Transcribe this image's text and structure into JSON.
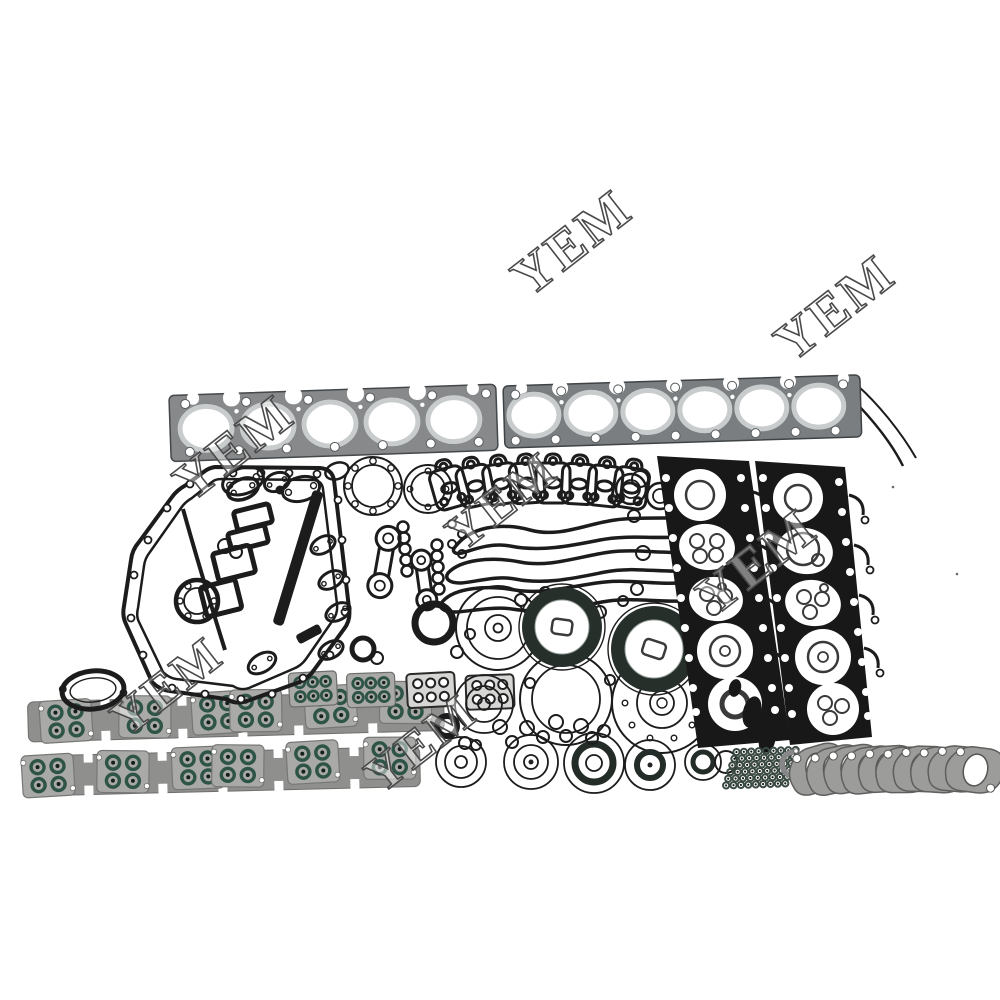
{
  "image": {
    "kind": "product-photo",
    "subject": "engine-overhaul-full-gasket-kit",
    "background": "#ffffff"
  },
  "watermarks": {
    "text": "YEM",
    "instances": [
      {
        "x": 575,
        "y": 247,
        "rotation": -38,
        "size": 54
      },
      {
        "x": 838,
        "y": 312,
        "rotation": -38,
        "size": 54
      },
      {
        "x": 237,
        "y": 452,
        "rotation": -38,
        "size": 54
      },
      {
        "x": 505,
        "y": 505,
        "rotation": -38,
        "size": 50
      },
      {
        "x": 760,
        "y": 566,
        "rotation": -38,
        "size": 54
      },
      {
        "x": 170,
        "y": 690,
        "rotation": -38,
        "size": 50
      },
      {
        "x": 424,
        "y": 747,
        "rotation": -38,
        "size": 50
      }
    ]
  },
  "colors": {
    "bg": "#ffffff",
    "ink": "#1c1c1c",
    "hgray": "#87898b",
    "hgray2": "#7b7e80",
    "borerim": "#c9cccd",
    "black": "#181818",
    "seal": "#262f2a",
    "green": "#2e5447",
    "greensm": "#3a4a42",
    "strip": "#8f8f8d",
    "plate": "#a9a9a7",
    "stack": "#9c9c9a",
    "wmstroke": "#4a4a4a"
  },
  "parts": [
    {
      "name": "cylinder-head-gasket-left",
      "bores": 5
    },
    {
      "name": "cylinder-head-gasket-right",
      "bores": 6
    },
    {
      "name": "front-cover-and-oil-pan-gasket-cluster"
    },
    {
      "name": "rocker-cover-gasket-fan-stack",
      "count": 8
    },
    {
      "name": "valve-cover-rubber-gasket-loops",
      "count": 3
    },
    {
      "name": "camshaft-dumbbell-gaskets",
      "count": 2
    },
    {
      "name": "crankshaft-oil-seals-dark",
      "count": 2
    },
    {
      "name": "o-ring-and-seal-assortment"
    },
    {
      "name": "black-head-plate-gasket-left"
    },
    {
      "name": "black-head-plate-gasket-right"
    },
    {
      "name": "exhaust-manifold-gasket-strips",
      "count": 2,
      "oring_clusters_per_strip": 6
    },
    {
      "name": "port-plate-gaskets-row",
      "count": 4
    },
    {
      "name": "small-green-oring-grid",
      "count": 54
    },
    {
      "name": "exhaust-flange-gasket-stack",
      "count": 10
    }
  ],
  "fan_stack": {
    "x0": 449,
    "dx": 26,
    "items": [
      {
        "y": 486,
        "rot": -16
      },
      {
        "y": 484,
        "rot": -12
      },
      {
        "y": 482,
        "rot": -8
      },
      {
        "y": 481,
        "rot": -4
      },
      {
        "y": 481,
        "rot": 0
      },
      {
        "y": 482,
        "rot": 3
      },
      {
        "y": 484,
        "rot": 6
      },
      {
        "y": 486,
        "rot": 9
      }
    ]
  },
  "flange_stack": {
    "x0": 818,
    "dx": 17.5,
    "y": 769,
    "rots": [
      -10,
      -6,
      -3,
      0,
      3,
      6,
      8,
      10,
      12,
      14
    ]
  },
  "oring_grid": {
    "x": 737,
    "y": 751,
    "cols": 9,
    "rows": 6,
    "dx": 7.4,
    "dy": 6.6,
    "row_shift": -2.3,
    "ring_radius": 3.1
  },
  "manifold_strips": [
    {
      "clusters": [
        {
          "x": 66,
          "y": 722,
          "rot": -2
        },
        {
          "x": 145,
          "y": 720,
          "rot": 2
        },
        {
          "x": 218,
          "y": 718,
          "rot": -2
        },
        {
          "x": 256,
          "y": 717,
          "rot": 1
        },
        {
          "x": 331,
          "y": 715,
          "rot": -2
        },
        {
          "x": 406,
          "y": 713,
          "rot": 2
        }
      ]
    },
    {
      "clusters": [
        {
          "x": 48,
          "y": 776,
          "rot": -2
        },
        {
          "x": 123,
          "y": 774,
          "rot": 2
        },
        {
          "x": 198,
          "y": 772,
          "rot": -1
        },
        {
          "x": 238,
          "y": 771,
          "rot": 2
        },
        {
          "x": 313,
          "y": 769,
          "rot": -2
        },
        {
          "x": 390,
          "y": 767,
          "rot": 1
        }
      ]
    }
  ],
  "small_plates": [
    {
      "x": 313,
      "y": 689,
      "rot": -3,
      "style": "green"
    },
    {
      "x": 371,
      "y": 690,
      "rot": -2,
      "style": "green"
    },
    {
      "x": 431,
      "y": 690,
      "rot": -3,
      "style": "outline"
    },
    {
      "x": 490,
      "y": 692,
      "rot": -2,
      "style": "outline"
    }
  ]
}
